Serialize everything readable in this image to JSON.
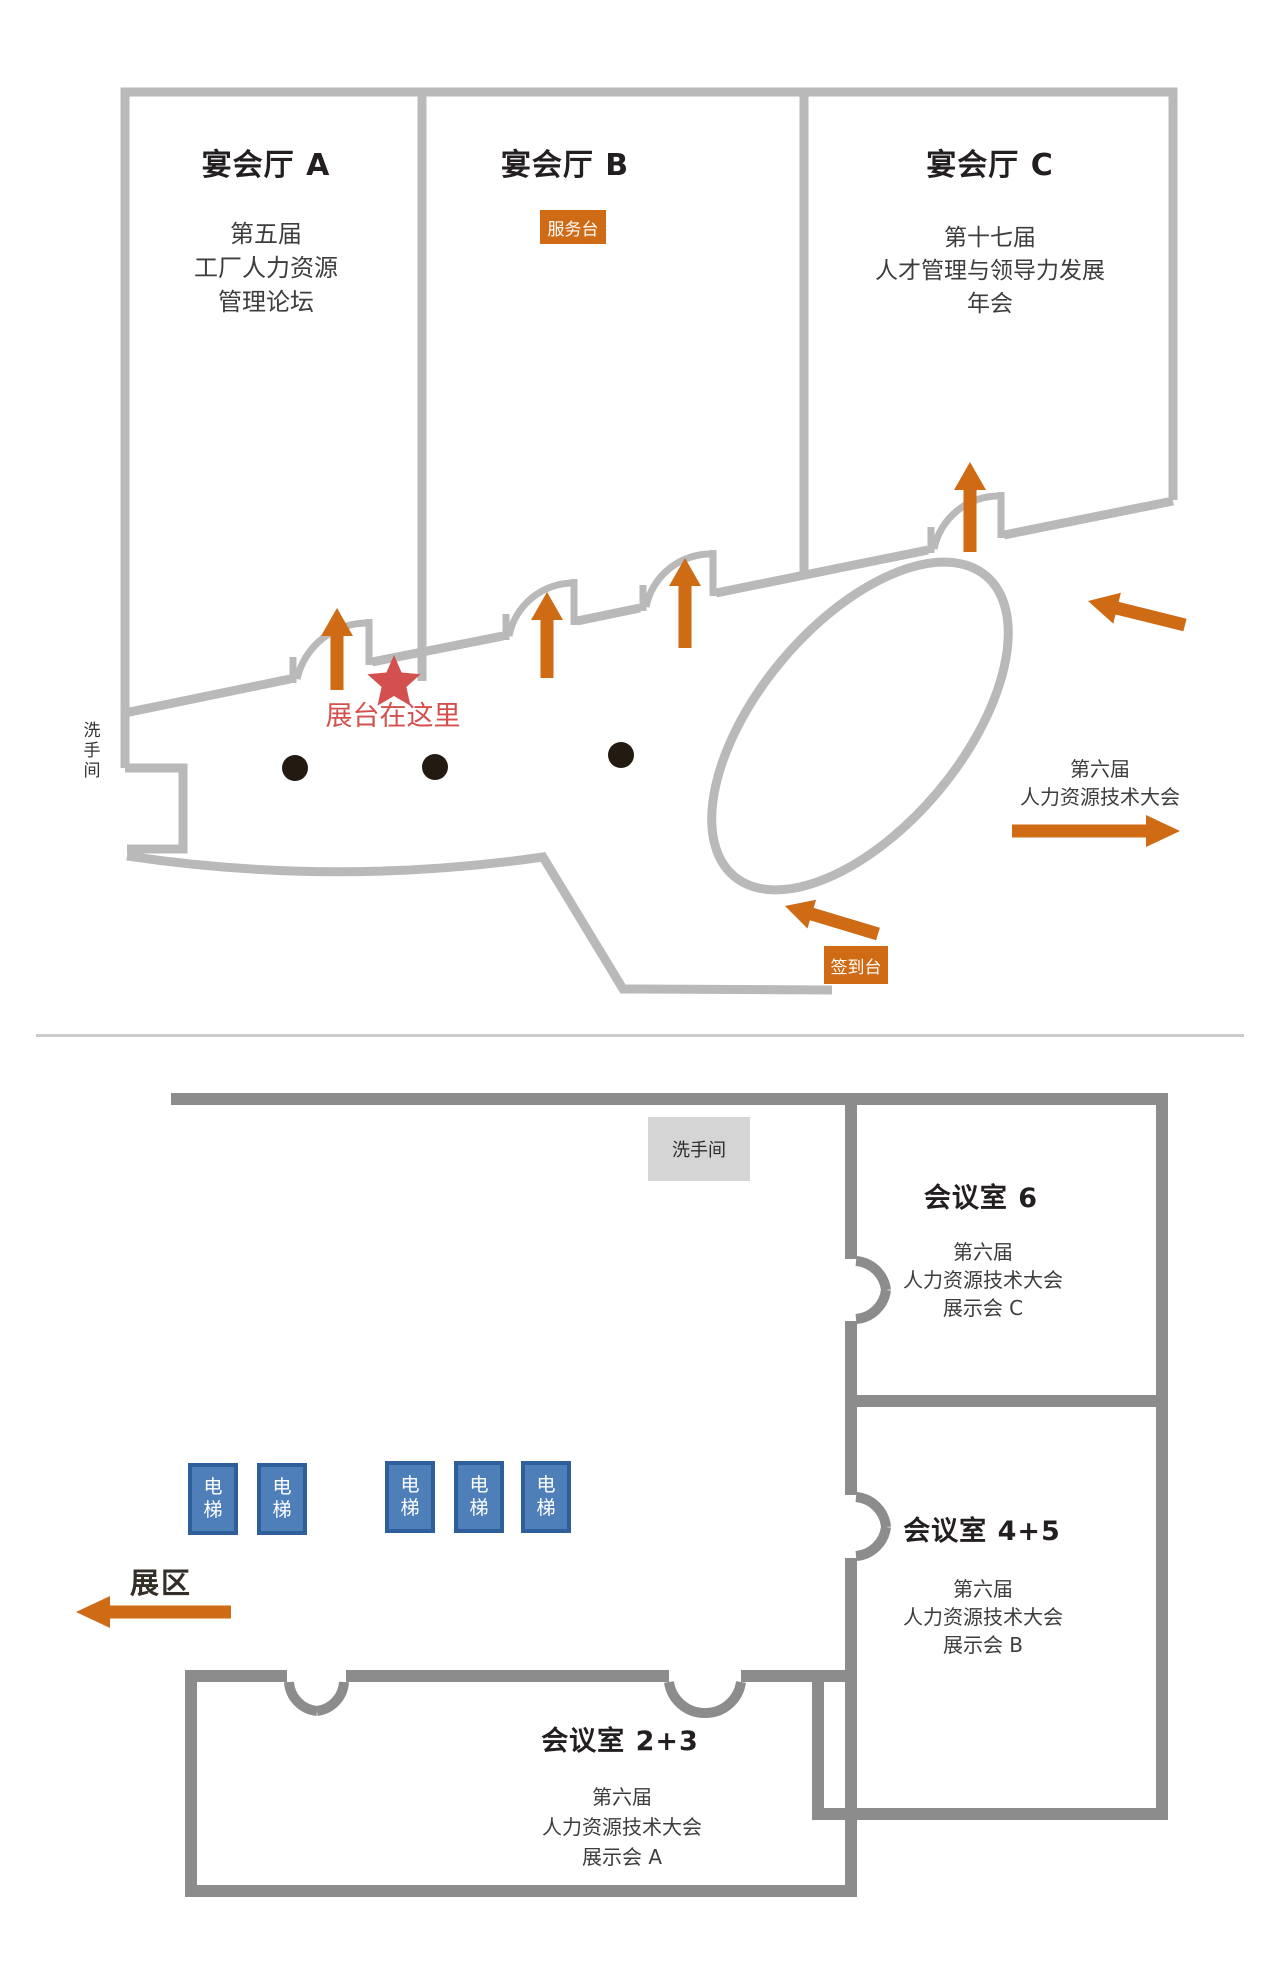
{
  "upper_floor": {
    "restroom": "洗手间",
    "halls": [
      {
        "name": "宴会厅 A",
        "event": [
          "第五届",
          "工厂人力资源",
          "管理论坛"
        ]
      },
      {
        "name": "宴会厅 B",
        "badge": "服务台"
      },
      {
        "name": "宴会厅 C",
        "event": [
          "第十七届",
          "人才管理与领导力发展",
          "年会"
        ]
      }
    ],
    "booth_marker": "展台在这里",
    "right_conference": [
      "第六届",
      "人力资源技术大会"
    ],
    "checkin_badge": "签到台"
  },
  "lower_floor": {
    "restroom": "洗手间",
    "rooms": [
      {
        "name": "会议室 6",
        "event": [
          "第六届",
          "人力资源技术大会",
          "展示会 C"
        ]
      },
      {
        "name": "会议室 4+5",
        "event": [
          "第六届",
          "人力资源技术大会",
          "展示会 B"
        ]
      },
      {
        "name": "会议室 2+3",
        "event": [
          "第六届",
          "人力资源技术大会",
          "展示会 A"
        ]
      }
    ],
    "elevators": [
      "电梯",
      "电梯",
      "电梯",
      "电梯",
      "电梯"
    ],
    "exhibition": "展区"
  },
  "colors": {
    "wall_light": "#b9b9b9",
    "wall_dark": "#8c8c8c",
    "accent_orange": "#cf6a15",
    "marker_red": "#d4504e",
    "elevator_blue": "#4f7fb8",
    "elevator_border": "#2e5f9b",
    "restroom_badge_gray": "#d5d5d5"
  }
}
